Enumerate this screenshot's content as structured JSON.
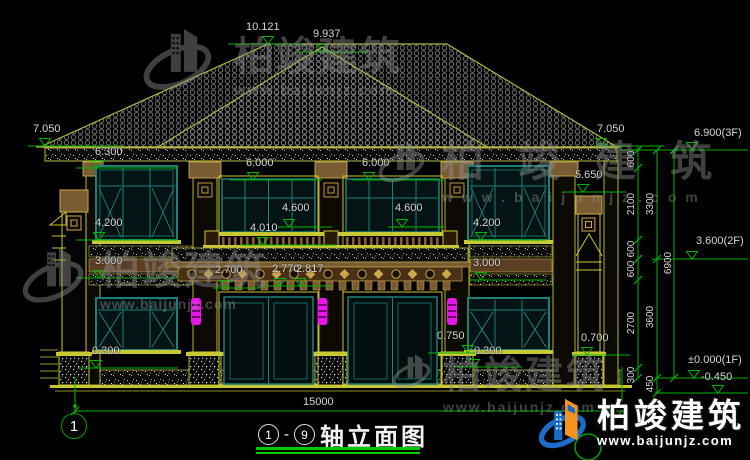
{
  "title": {
    "axis_from": "1",
    "separator": "-",
    "axis_to": "9",
    "text": "轴立面图"
  },
  "axis": {
    "bubble_left": "1"
  },
  "dims": {
    "overall_width": "15000",
    "levels": {
      "ridge": "10.121",
      "ridge2": "9.937",
      "eave_l": "7.050",
      "eave_r": "7.050",
      "f3": "6.900(3F)",
      "win_top": "6.300",
      "door_top_a": "6.000",
      "door_top_b": "6.000",
      "bay_roof": "5.650",
      "sill_a": "4.600",
      "sill_b": "4.600",
      "win_sill_l": "4.200",
      "win_sill_r": "4.200",
      "railing": "4.010",
      "f2": "3.600(2F)",
      "band_l": "3.000",
      "band_r": "3.000",
      "porch_a": "2.700",
      "porch_b": "2.770",
      "porch_c": "2.817",
      "plinth_a": "0.750",
      "plinth_b": "0.700",
      "base_l": "0.300",
      "base_r": "0.300",
      "f1": "±0.000(1F)",
      "ground": "-0.450"
    },
    "vertical": {
      "a": "600",
      "b": "2100",
      "c": "600",
      "d": "600",
      "e": "2700",
      "f": "300",
      "g": "3300",
      "h": "3600",
      "i": "450",
      "j": "6900"
    }
  },
  "watermark": {
    "brand": "柏竣建筑",
    "url": "www.baijunjz.com"
  },
  "logo": {
    "brand": "柏竣建筑",
    "url": "www.baijunjz.com"
  },
  "colors": {
    "dim_green": "#00b400",
    "trim_yellow": "#c8c832",
    "frame_teal": "#1d8078",
    "lamp_magenta": "#e816e8",
    "logo_blue": "#1a6ec7",
    "logo_orange": "#f7941d"
  }
}
